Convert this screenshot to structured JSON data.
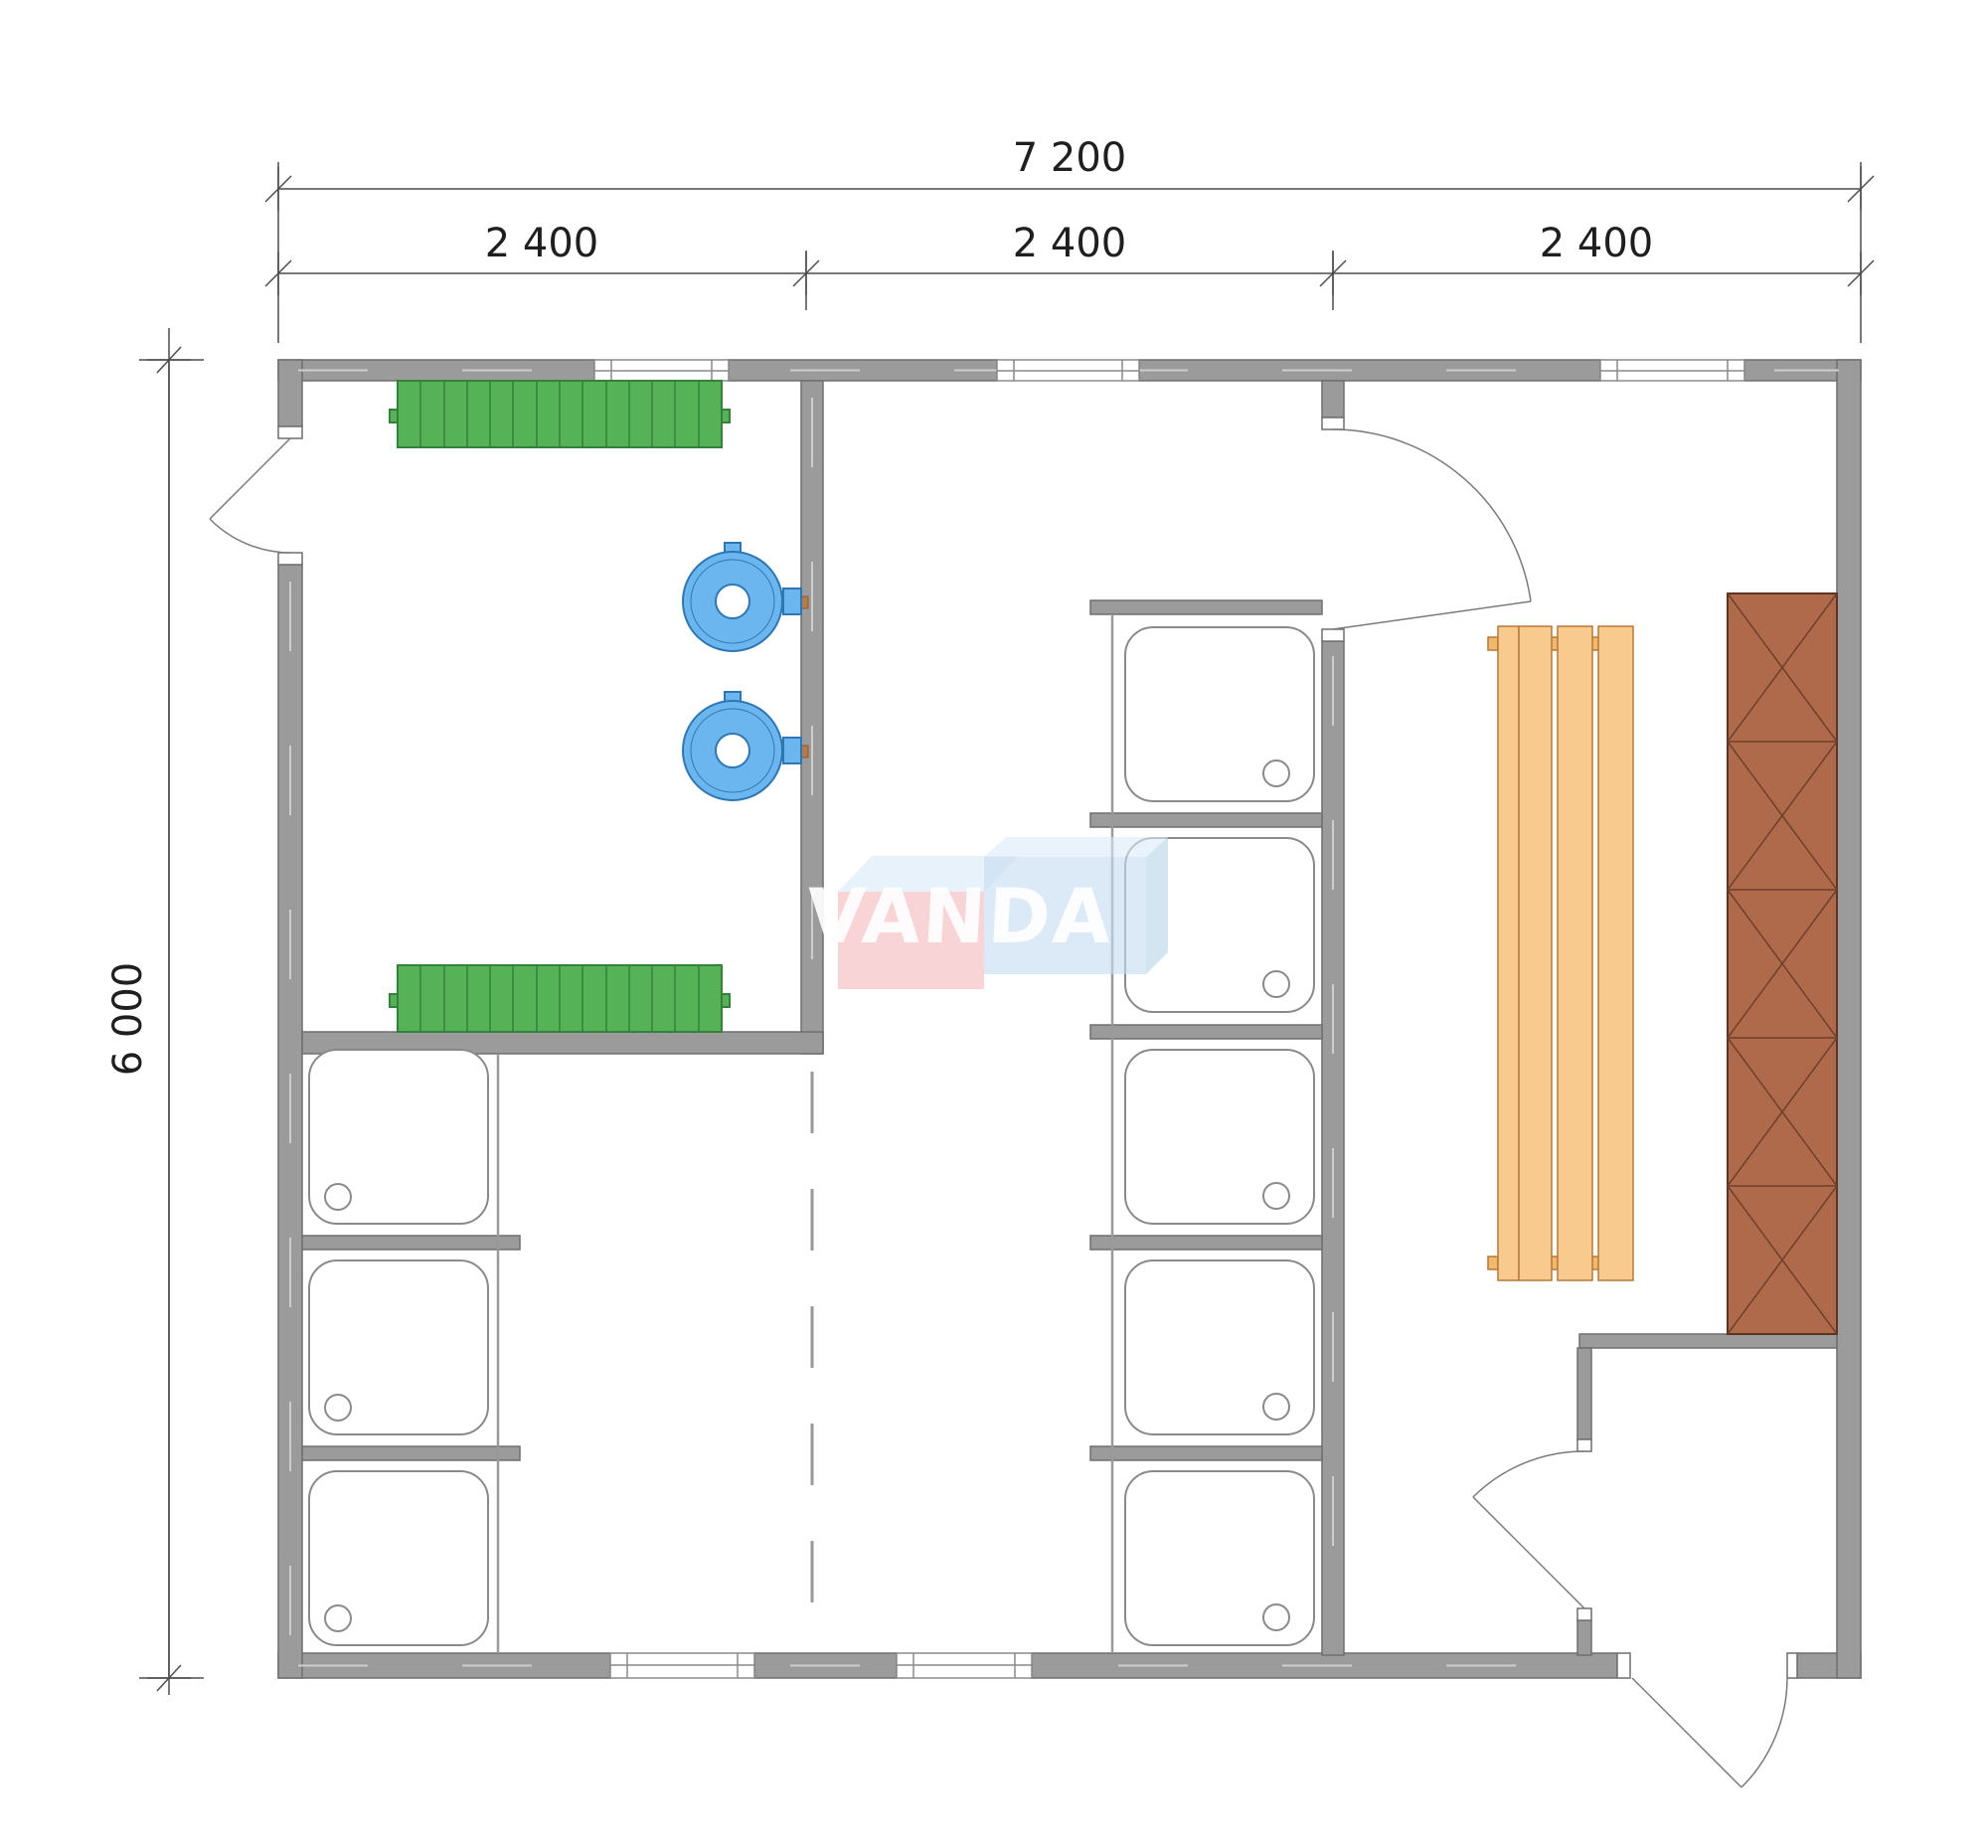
{
  "drawing": {
    "type": "bathhouse floor plan",
    "watermark": {
      "text": "VANDA"
    },
    "dimensions": {
      "total_width_label": "7 200",
      "segment_labels": [
        "2 400",
        "2 400",
        "2 400"
      ],
      "total_height_label": "6 000"
    },
    "fixtures": {
      "radiator_count": 2,
      "washbasin_count": 2,
      "shower_tray_count": 8,
      "bench_count": 1,
      "stove_count": 1,
      "door_count": 4,
      "window_count": 5
    },
    "colors": {
      "wall_fill": "#9b9b9b",
      "wall_outline": "#6f6f6f",
      "radiator_green": "#55b257",
      "basin_blue": "#6cb6f0",
      "bench_orange": "#f8ca8e",
      "stove_brown": "#ae6a4a",
      "logo_pink": "#f5bcbf",
      "logo_blue": "#c6dcf0",
      "dimension_text": "#1f1f1f"
    }
  }
}
